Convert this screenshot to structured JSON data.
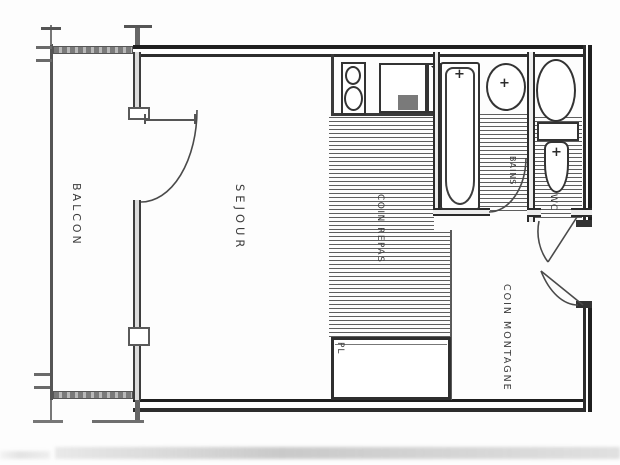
{
  "plan": {
    "type": "apartment-floor-plan",
    "rooms": {
      "balcony": {
        "label": "BALCON"
      },
      "living": {
        "label": "SEJOUR"
      },
      "dining": {
        "label": "COIN REPAS"
      },
      "bath": {
        "label": "BAINS"
      },
      "wc": {
        "label": "WC"
      },
      "mountain": {
        "label": "COIN MONTAGNE"
      },
      "closet": {
        "label": "PL"
      }
    },
    "fixtures": {
      "faucet_mark": "+"
    },
    "colors": {
      "line": "#2d2d2d",
      "hatch": "#373737",
      "background": "#fdfdfd",
      "scan_gray": "#9a9a9a"
    }
  }
}
